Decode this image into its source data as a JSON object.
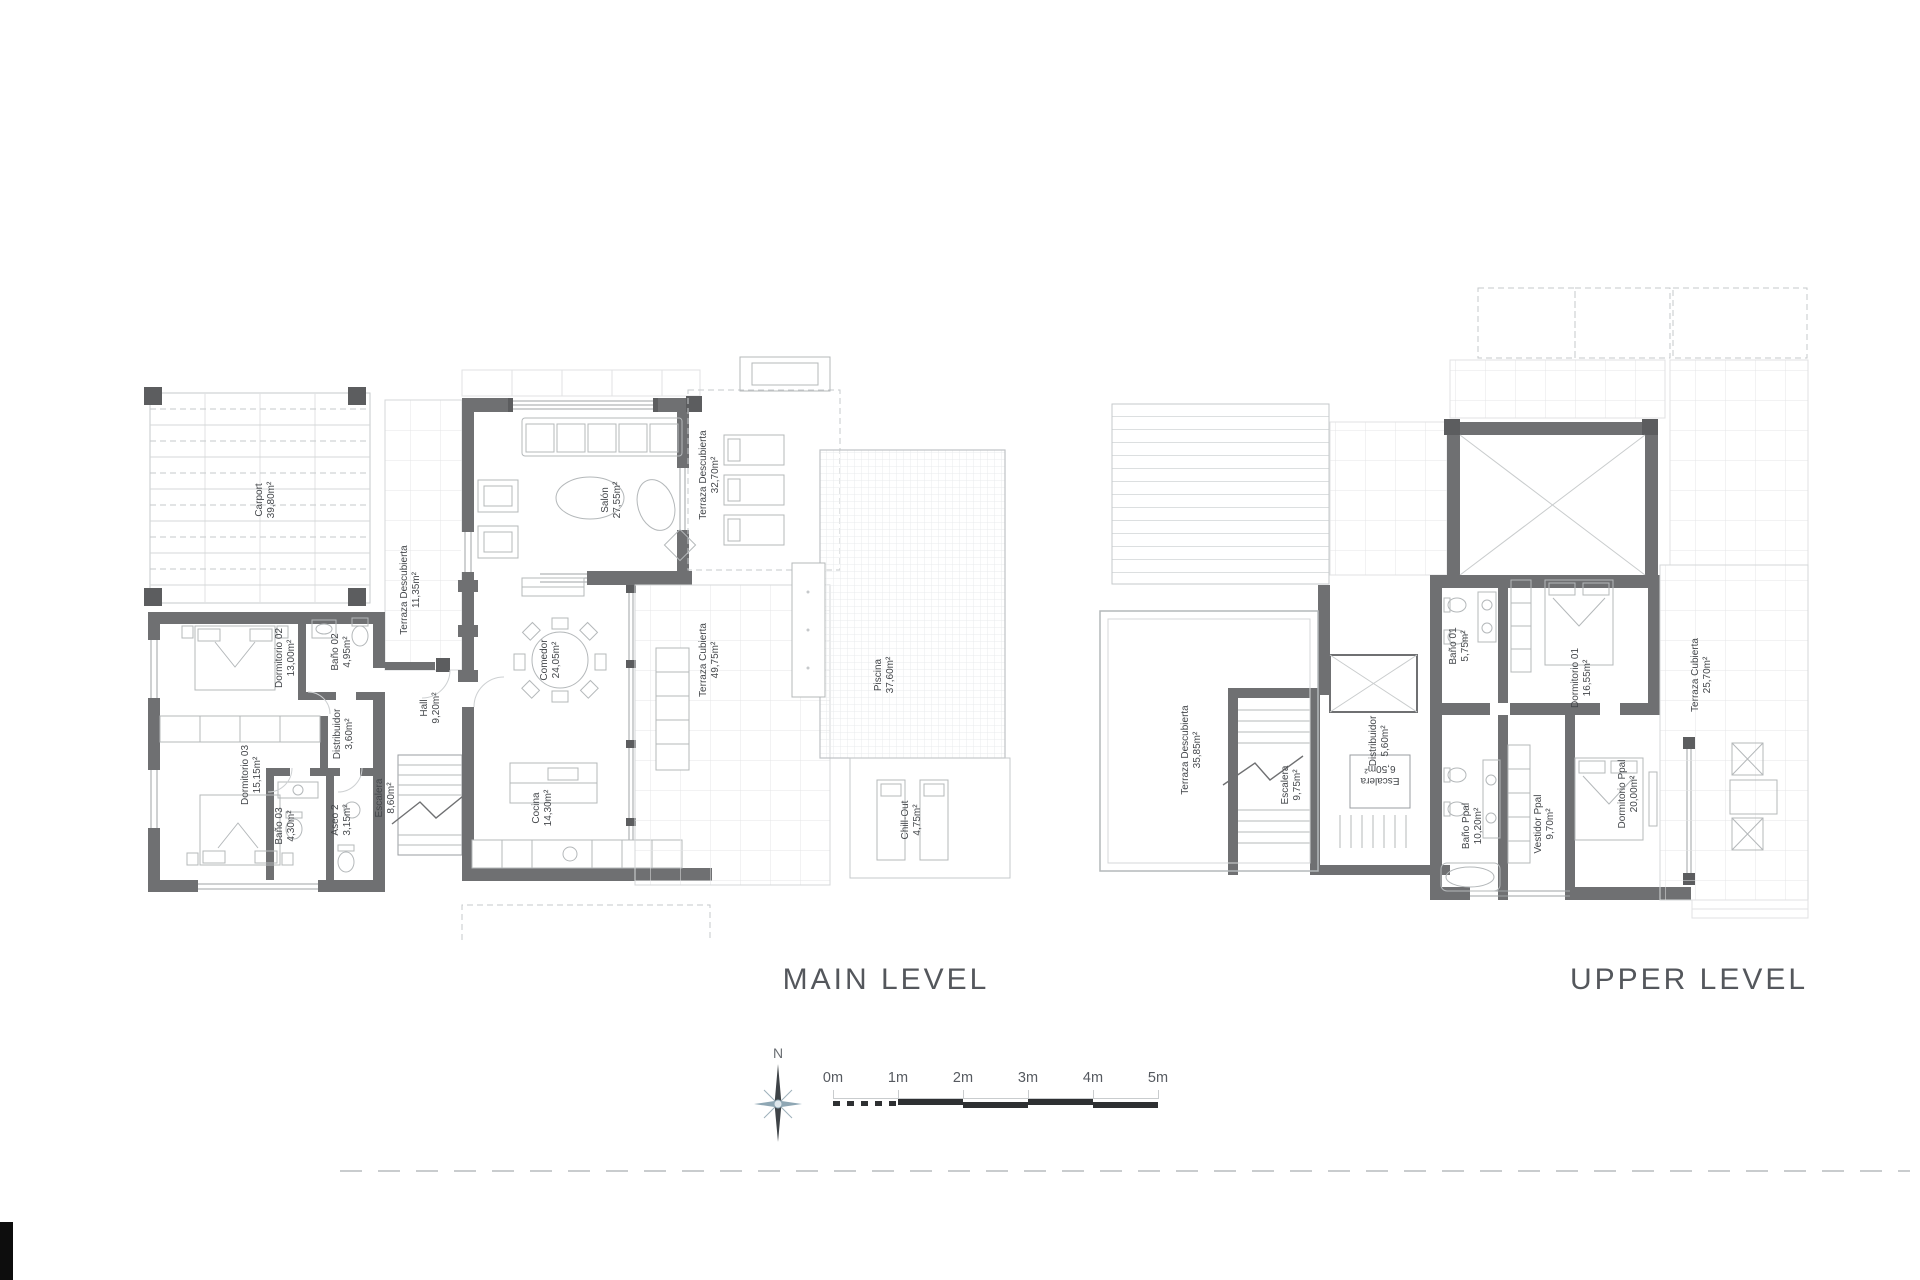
{
  "main_level": {
    "title": "MAIN LEVEL",
    "rooms": [
      {
        "name": "Carport",
        "area": "39,80m²"
      },
      {
        "name": "Dormitorio 02",
        "area": "13,00m²"
      },
      {
        "name": "Baño 02",
        "area": "4,95m²"
      },
      {
        "name": "Distribuidor",
        "area": "3,60m²"
      },
      {
        "name": "Dormitorio 03",
        "area": "15,15m²"
      },
      {
        "name": "Baño 03",
        "area": "4,30m²"
      },
      {
        "name": "Aseo 2",
        "area": "3,15m²"
      },
      {
        "name": "Escalera",
        "area": "8,60m²"
      },
      {
        "name": "Hall",
        "area": "9,20m²"
      },
      {
        "name": "Terraza Descubierta",
        "area": "11,35m²"
      },
      {
        "name": "Salón",
        "area": "27,55m²"
      },
      {
        "name": "Comedor",
        "area": "24,05m²"
      },
      {
        "name": "Cocina",
        "area": "14,30m²"
      },
      {
        "name": "Terraza Cubierta",
        "area": "49,75m²"
      },
      {
        "name": "Terraza Descubierta",
        "area": "32,70m²"
      },
      {
        "name": "Piscina",
        "area": "37,60m²"
      },
      {
        "name": "Chill-Out",
        "area": "4,75m²"
      }
    ]
  },
  "upper_level": {
    "title": "UPPER LEVEL",
    "rooms": [
      {
        "name": "Terraza Descubierta",
        "area": "35,85m²"
      },
      {
        "name": "Escalera",
        "area": "9,75m²"
      },
      {
        "name": "Distribuidor",
        "area": "5,60m²"
      },
      {
        "name": "Escalera",
        "area": "6,50m²"
      },
      {
        "name": "Baño 01",
        "area": "5,75m²"
      },
      {
        "name": "Dormitorio 01",
        "area": "16,55m²"
      },
      {
        "name": "Terraza Cubierta",
        "area": "25,70m²"
      },
      {
        "name": "Baño Ppal",
        "area": "10,20m²"
      },
      {
        "name": "Vestidor Ppal",
        "area": "9,70m²"
      },
      {
        "name": "Dormitorio Ppal",
        "area": "20,00m²"
      }
    ]
  },
  "scale": {
    "north_label": "N",
    "labels": [
      "0m",
      "1m",
      "2m",
      "3m",
      "4m",
      "5m"
    ]
  },
  "colors": {
    "wall": "#6f7072",
    "wall_dark": "#5c5d5f",
    "furniture_line": "#b4b8ba",
    "light_line": "#d4d7d8",
    "label_text": "#43464a",
    "title_text": "#54575c",
    "scale_bar_dark": "#2e3032",
    "compass_accent": "#8fa7b4"
  }
}
